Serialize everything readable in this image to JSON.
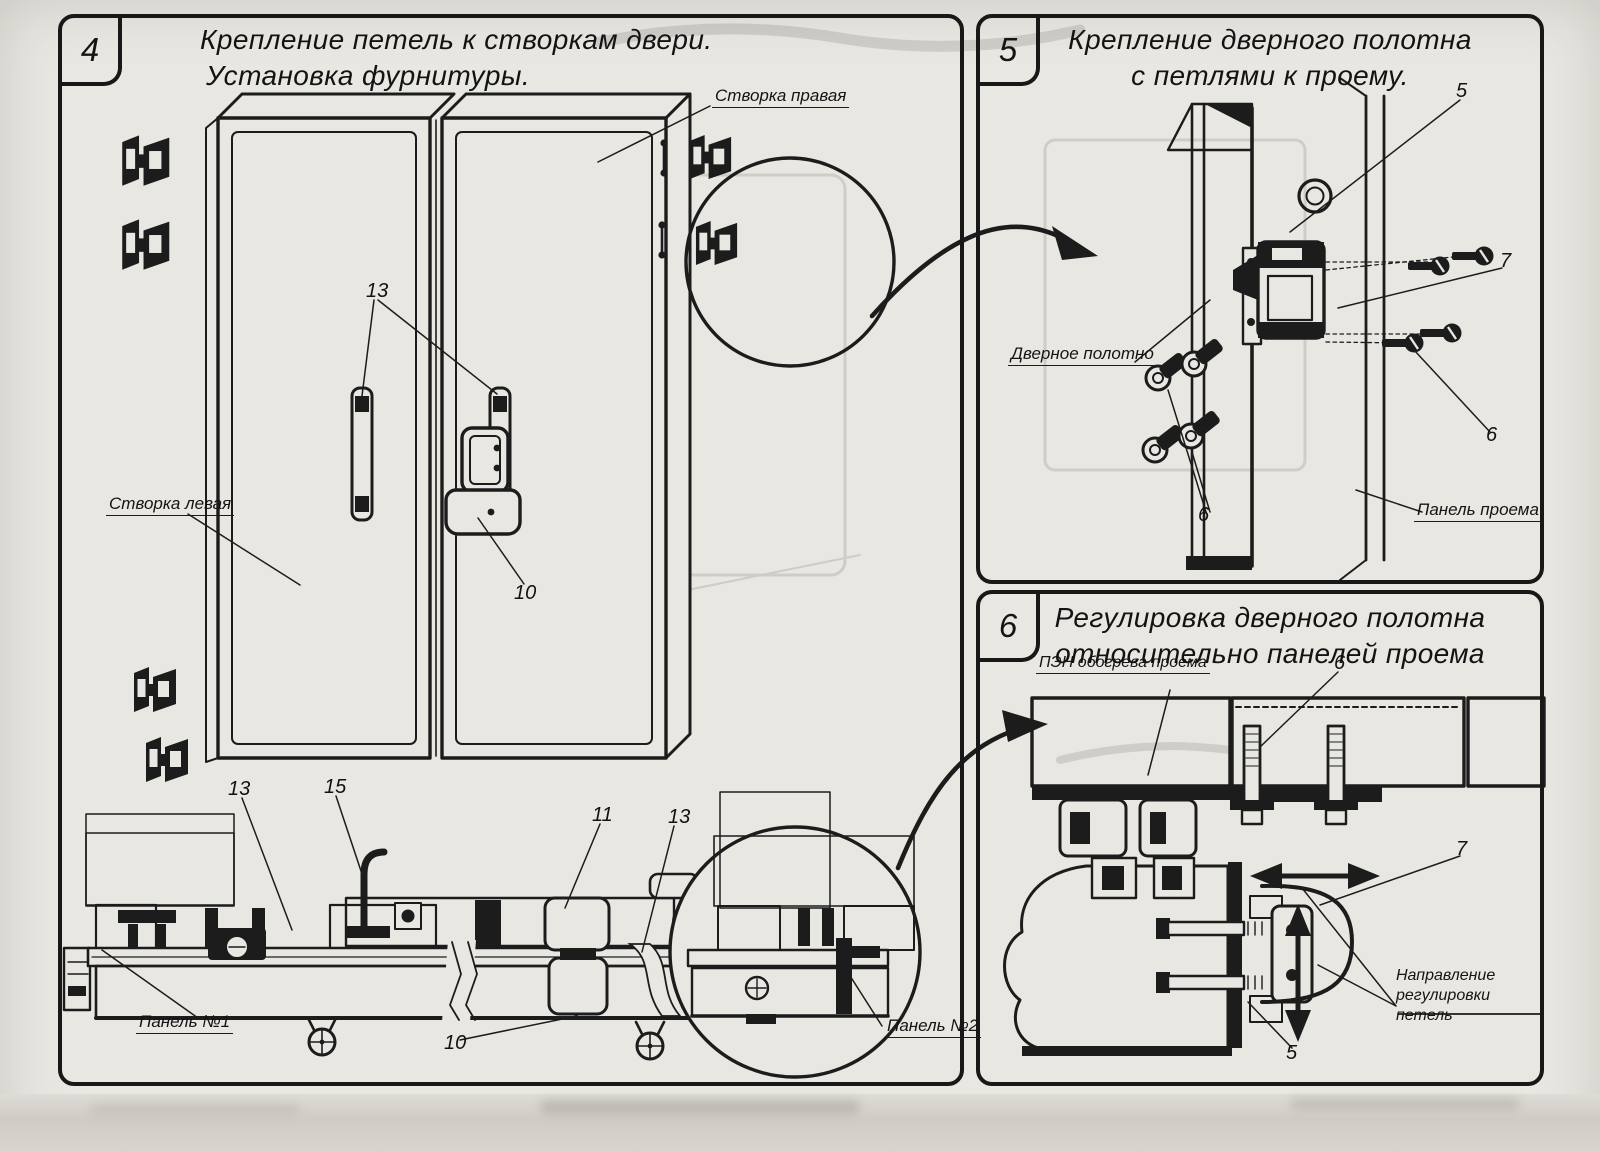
{
  "colors": {
    "paper": "#e9e7e2",
    "ink": "#1c1c1c"
  },
  "panel4": {
    "number": "4",
    "title_line1": "Крепление петель к створкам двери.",
    "title_line2": "Установка фурнитуры.",
    "labels": {
      "right_leaf": "Створка правая",
      "left_leaf": "Створка левая",
      "panel1": "Панель №1",
      "panel2": "Панель №2"
    },
    "callouts": {
      "handles": "13",
      "latch": "10",
      "floor_left": "13",
      "hook": "15",
      "mechanism": "11",
      "floor_right": "13",
      "floor_latch": "10"
    }
  },
  "panel5": {
    "number": "5",
    "title_line1": "Крепление дверного полотна",
    "title_line2": "с петлями к проему.",
    "labels": {
      "door_leaf": "Дверное полотно",
      "opening_panel": "Панель проема"
    },
    "callouts": {
      "hinge": "5",
      "plate": "7",
      "screws_right": "6",
      "screws_left": "6"
    }
  },
  "panel6": {
    "number": "6",
    "title_line1": "Регулировка дверного полотна",
    "title_line2": "относительно панелей проема",
    "labels": {
      "pen": "ПЭН обогрева проема",
      "direction_line1": "Направление регулировки",
      "direction_line2": "петель"
    },
    "callouts": {
      "bolt": "6",
      "hinge_plate": "7",
      "hinge": "5"
    }
  }
}
